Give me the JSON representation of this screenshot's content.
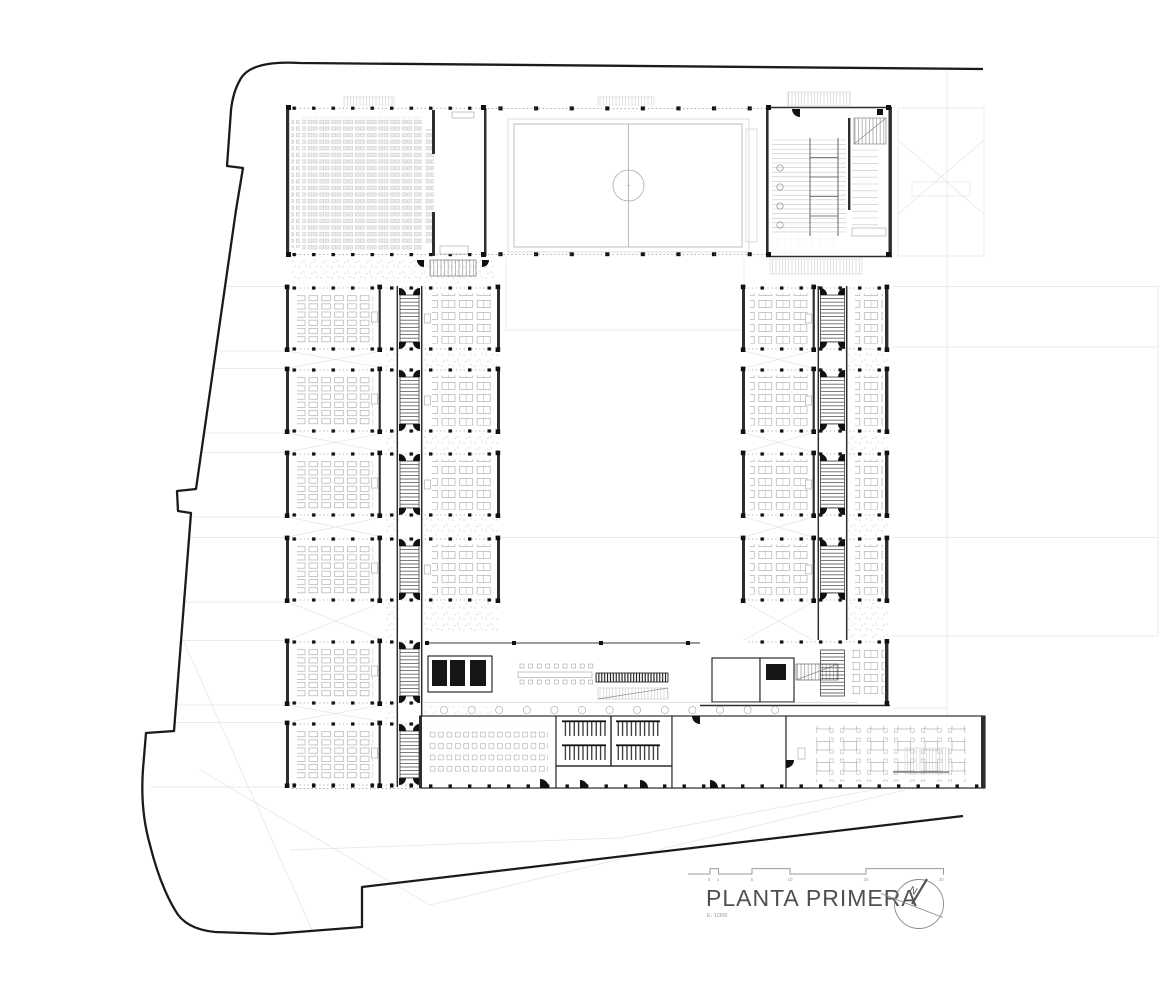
{
  "title_block": {
    "title": "PLANTA PRIMERA",
    "scale_note": "E: 1/300",
    "north_label": "N"
  },
  "scale_bar": {
    "ticks": [
      "0",
      "1",
      "5",
      "10",
      "20",
      "30"
    ]
  },
  "colors": {
    "paper": "#ffffff",
    "ink": "#1b1b1b",
    "wall": "#2e2e2e",
    "col": "#111111",
    "mid": "#8c8c8c",
    "light": "#c6c6c6",
    "faint": "#e4e4e4",
    "title": "#4f4f4f"
  }
}
